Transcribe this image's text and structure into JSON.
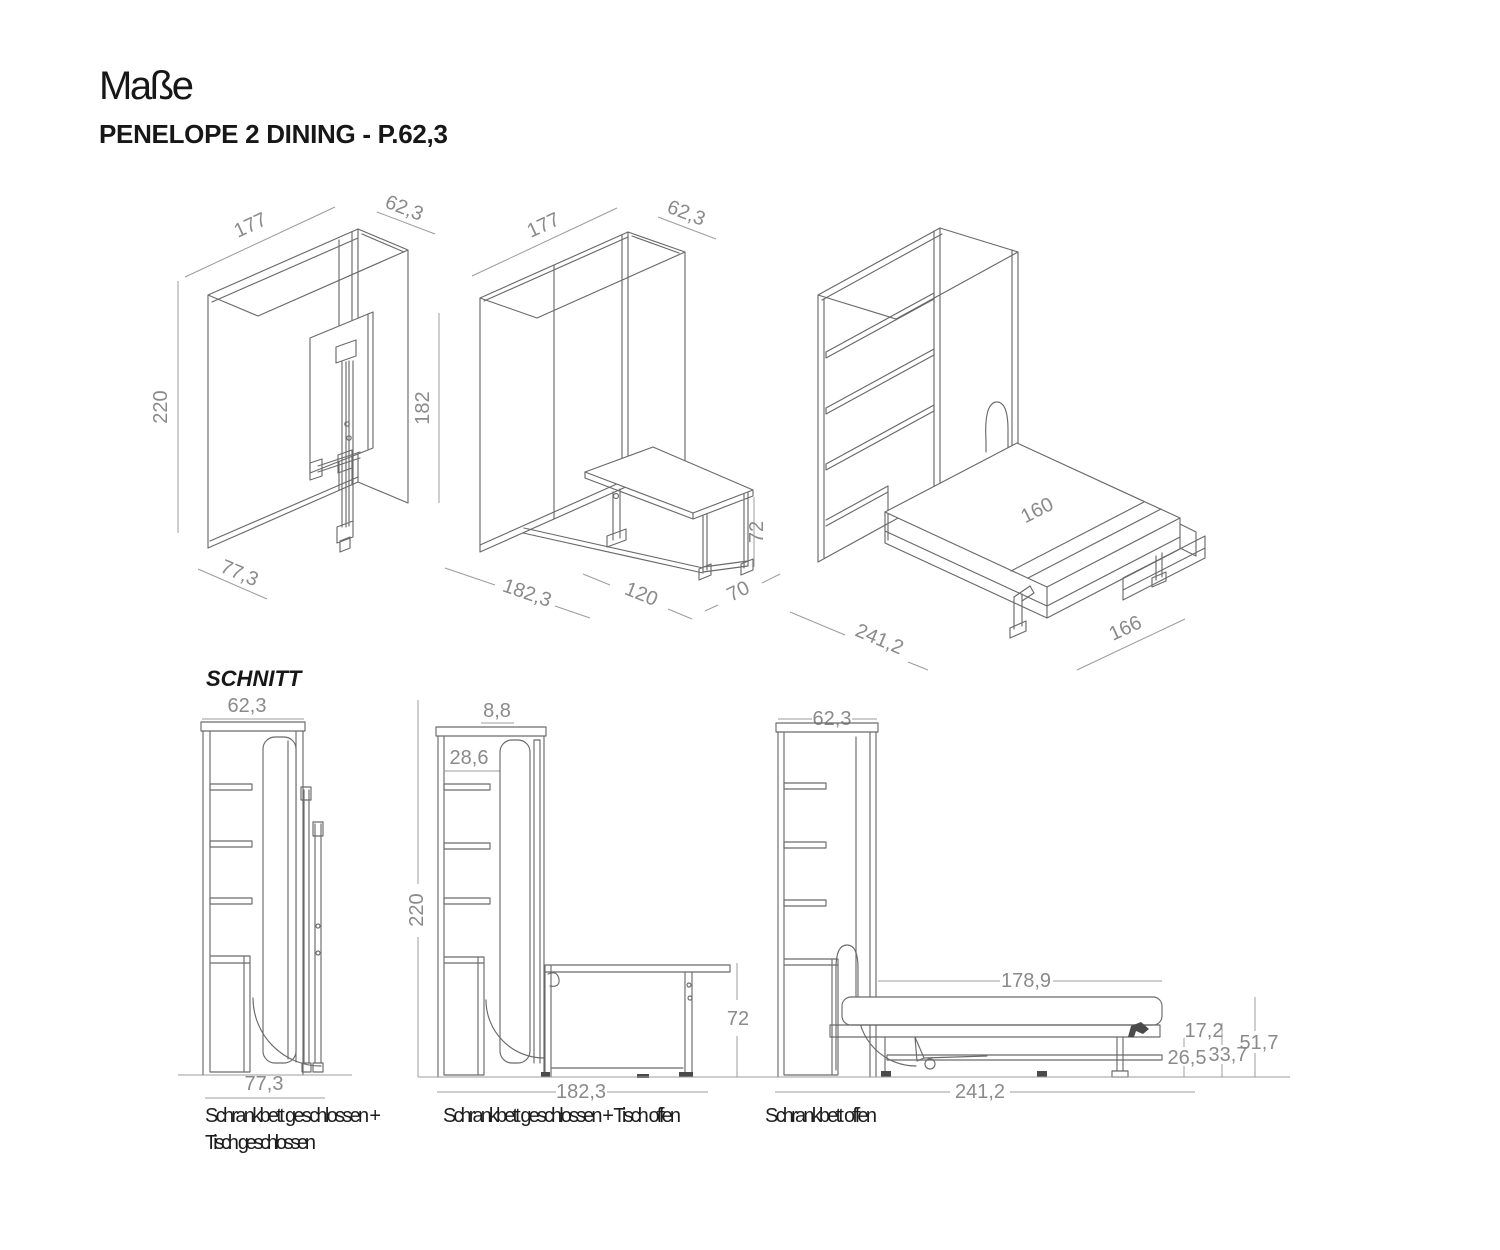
{
  "header": {
    "title": "Maße",
    "subtitle": "PENELOPE 2 DINING - P.62,3",
    "section_label": "SCHNITT"
  },
  "views": {
    "iso_closed": {
      "width": "177",
      "depth": "62,3",
      "height": "220",
      "panel_height": "182",
      "base_depth": "77,3"
    },
    "iso_table_open": {
      "width": "177",
      "depth": "62,3",
      "base_depth": "182,3",
      "table_width": "120",
      "table_depth": "70",
      "table_height": "72"
    },
    "iso_bed_open": {
      "bed_width": "160",
      "total_depth": "241,2",
      "bed_outer_width": "166"
    },
    "sec_closed": {
      "depth": "62,3",
      "base_depth": "77,3",
      "caption_line1": "Schrankbett geschlossen +",
      "caption_line2": "Tisch geschlossen"
    },
    "sec_table_open": {
      "top_gap": "8,8",
      "shelf_depth": "28,6",
      "height": "220",
      "table_height": "72",
      "base_depth": "182,3",
      "caption": "Schrankbett geschlossen + Tisch offen"
    },
    "sec_bed_open": {
      "depth": "62,3",
      "bed_length": "178,9",
      "total_depth": "241,2",
      "frame_gap": "17,2",
      "table_height": "26,5",
      "frame_height": "33,7",
      "bed_height": "51,7",
      "caption": "Schrankbett offen"
    }
  }
}
